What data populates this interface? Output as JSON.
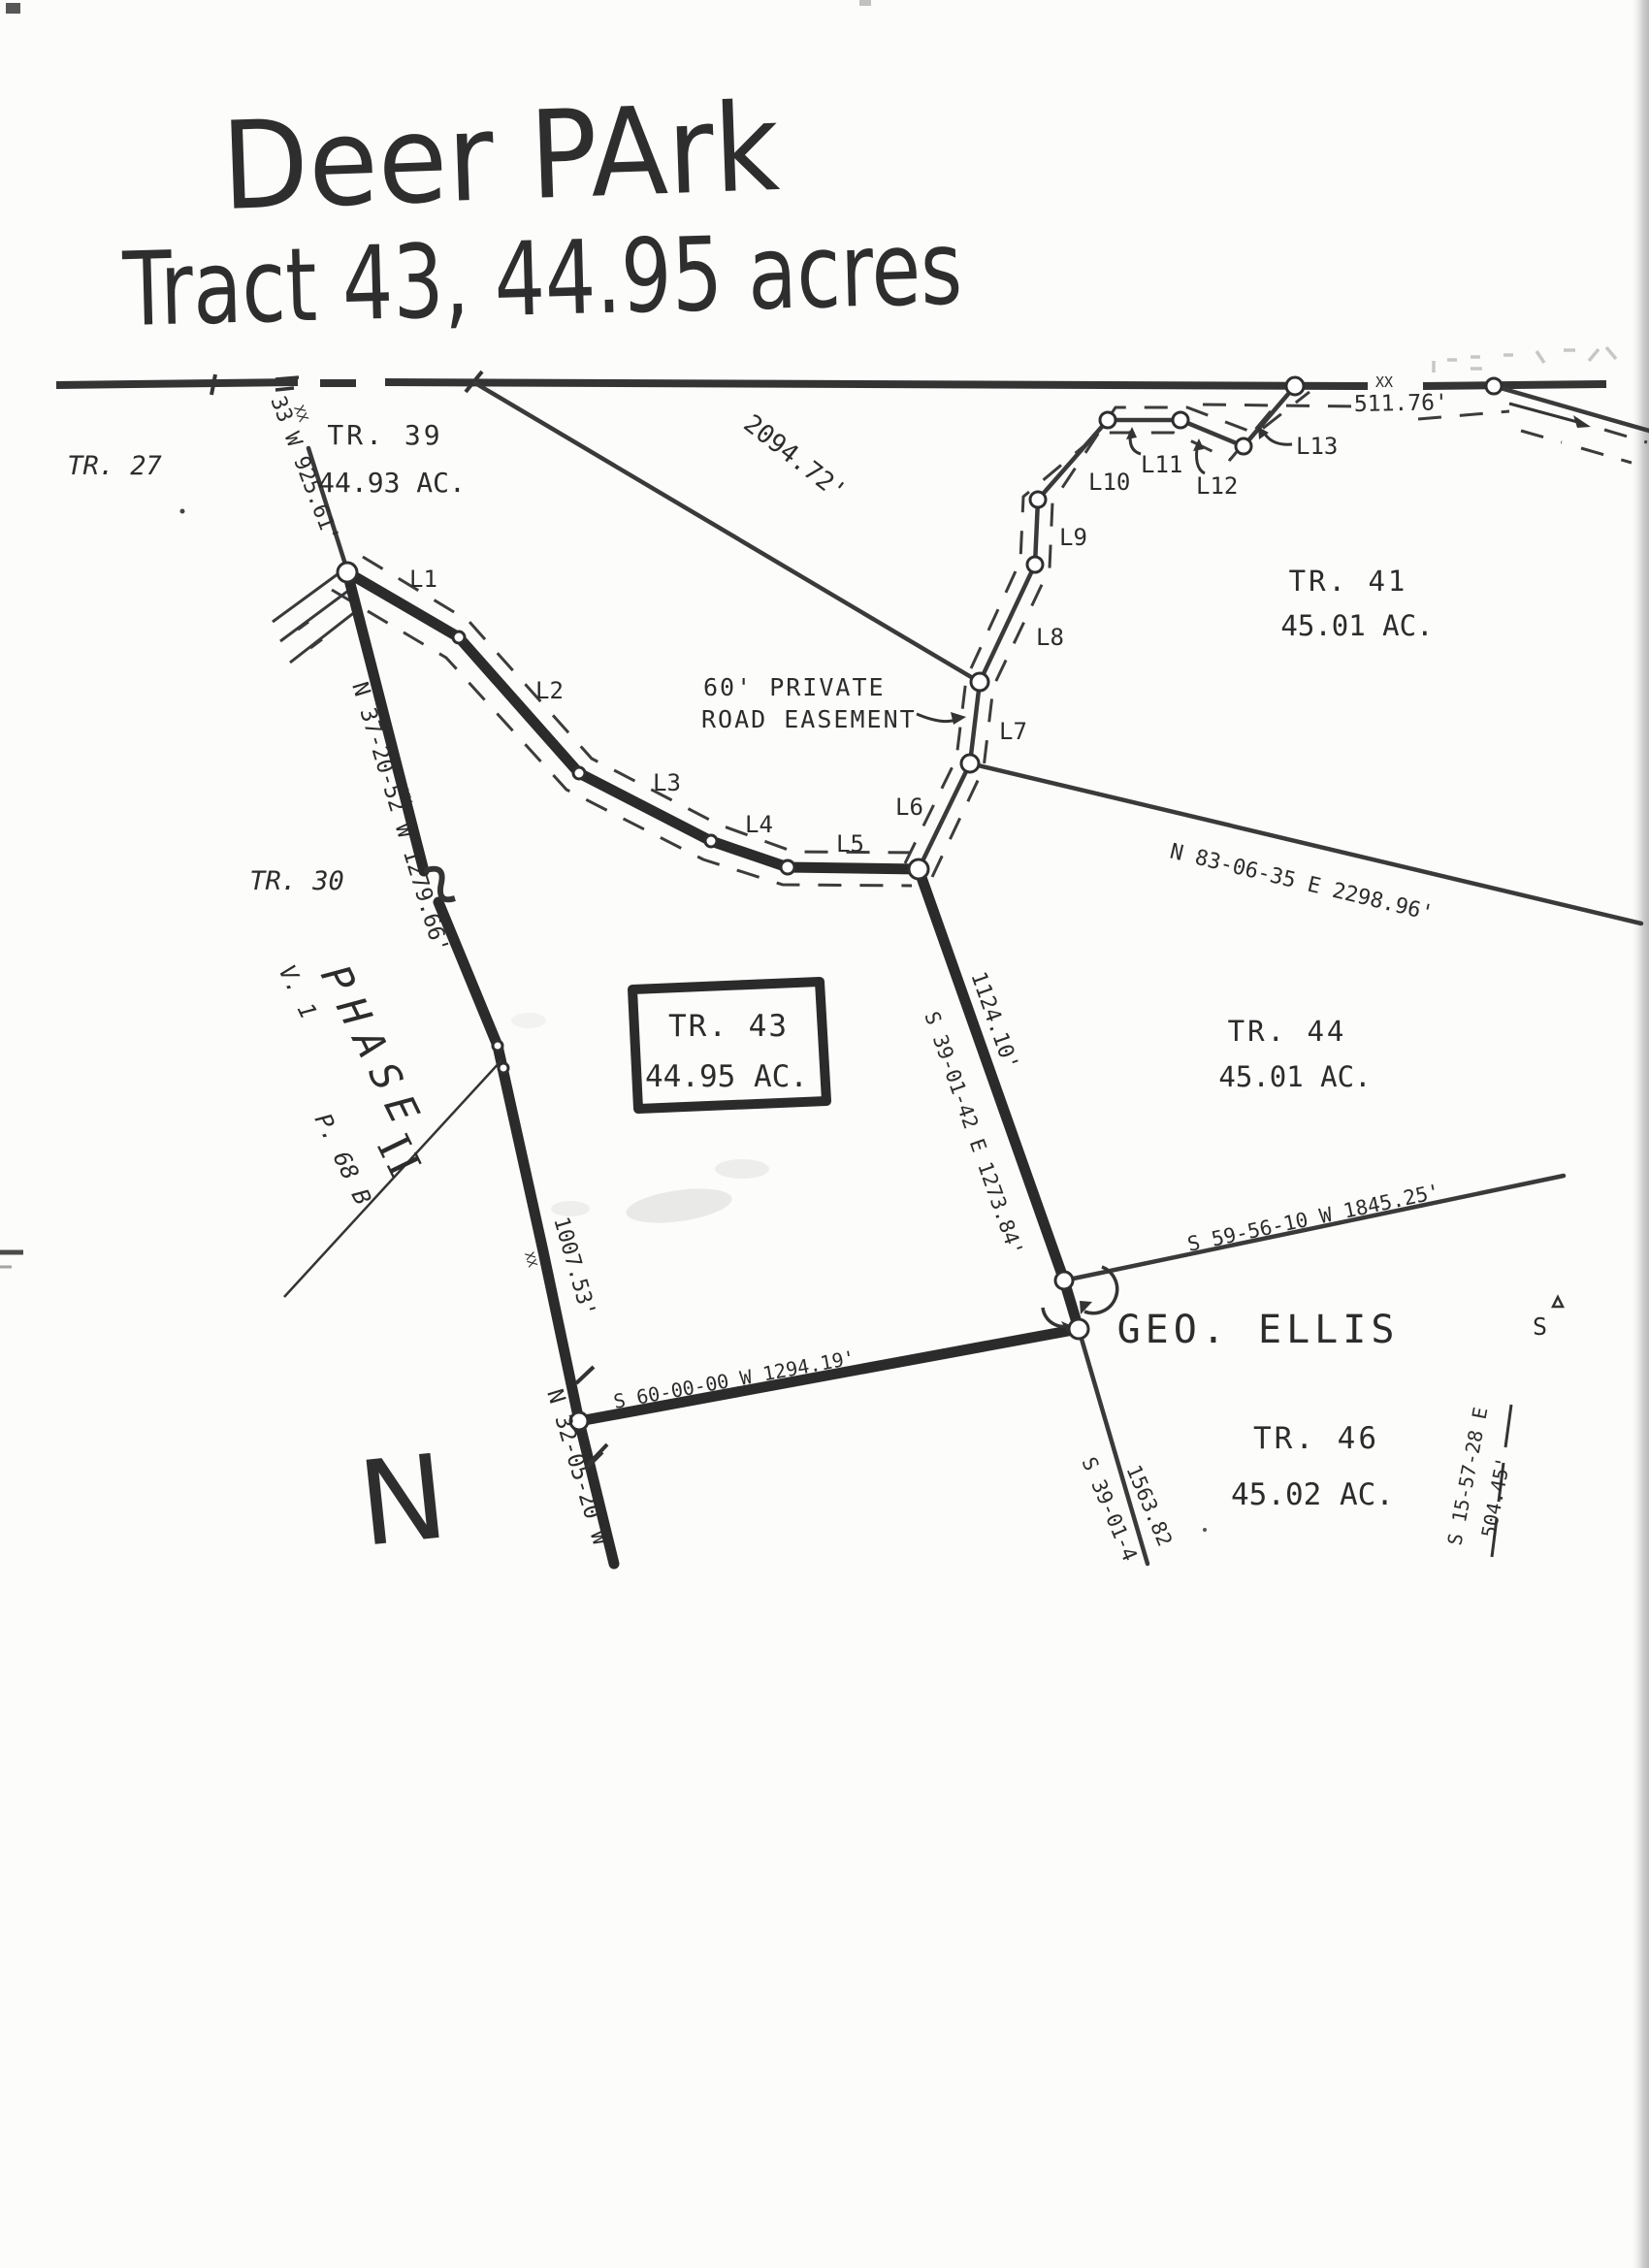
{
  "title": {
    "line1": "Deer PArk",
    "line2": "Tract 43, 44.95 acres"
  },
  "north_label": "N",
  "tracts": {
    "tr27": {
      "name": "TR. 27"
    },
    "tr30": {
      "name": "TR. 30"
    },
    "tr39": {
      "name": "TR. 39",
      "acreage": "44.93 AC."
    },
    "tr41": {
      "name": "TR. 41",
      "acreage": "45.01 AC."
    },
    "tr43": {
      "name": "TR. 43",
      "acreage": "44.95 AC."
    },
    "tr44": {
      "name": "TR. 44",
      "acreage": "45.01 AC."
    },
    "tr46": {
      "name": "TR. 46",
      "acreage": "45.02 AC."
    }
  },
  "owner": {
    "name": "GEO. ELLIS"
  },
  "phase": {
    "word": "PHASE",
    "numeral": "II",
    "volume": "V. 1",
    "page": "P. 68 B"
  },
  "easement": {
    "label_line1": "60' PRIVATE",
    "label_line2": "ROAD EASEMENT",
    "segments": [
      "L1",
      "L2",
      "L3",
      "L4",
      "L5",
      "L6",
      "L7",
      "L8",
      "L9",
      "L10",
      "L11",
      "L12",
      "L13"
    ]
  },
  "bearings": {
    "top_left_line": "33 W 925.61'",
    "top_right_dist": "511.76'",
    "top_diagonal": "2094.72'",
    "tr41_tr44_line": "N 83-06-35 E  2298.96'",
    "tr44_tr46_line": "S 59-56-10 W  1845.25'",
    "tr43_east": "S 39-01-42 E 1273.84'",
    "tr43_east_dist": "1124.10'",
    "tr43_south": "S 60-00-00 W   1294.19'",
    "tr43_west_upper": "N 37-20-52 W 1279.66'",
    "tr43_west_dist": "1007.53'",
    "tr43_west_lower": "N 32-05-20 W",
    "tr46_west": "S 39-01-4",
    "tr46_west_dist": "1563.82",
    "right_edge": "S 15-57-28 E",
    "right_edge_dist": "504.45'",
    "xx_mark": "XX",
    "edge_fragment": "S"
  }
}
